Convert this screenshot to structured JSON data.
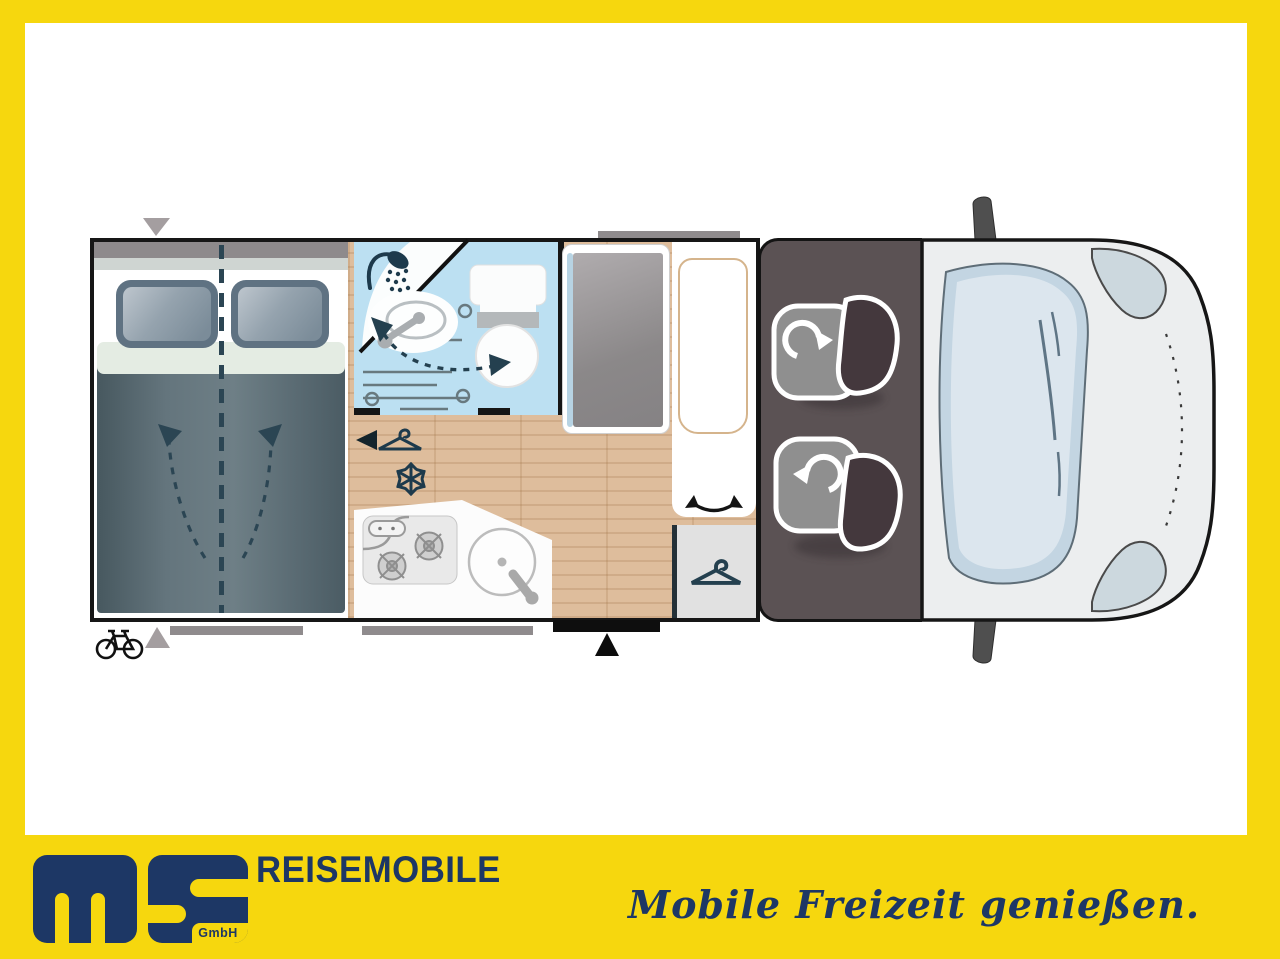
{
  "brand": {
    "company_short": "ms",
    "company_suffix": "GmbH",
    "wordmark": "REISEMOBILE",
    "tagline": "Mobile Freizeit genießen."
  },
  "palette": {
    "frame_yellow": "#f6d70e",
    "brand_navy": "#1d3765",
    "wall_black": "#161616",
    "bathroom_blue": "#bce0f2",
    "wood_floor": "#debd9c",
    "cab_gray": "#5b5254",
    "van_body": "#eceeef",
    "duvet_slate": "#5a6c74",
    "icon_teal": "#1d3a4c"
  },
  "floorplan": {
    "icons": [
      "shower-icon",
      "bath-sink-icon",
      "toilet-icon",
      "door-swing-arrow",
      "wardrobe-door-marker",
      "hanger-icon",
      "snowflake-icon",
      "hob-icon",
      "kitchen-sink-icon",
      "bed-fold-arrows",
      "bed-centerline",
      "entry-door-marker",
      "bike-rack-icon",
      "seat-swivel-arrow",
      "swivel-seat-icons",
      "mirror-icons",
      "headlight-shapes",
      "seagull-icons"
    ]
  }
}
